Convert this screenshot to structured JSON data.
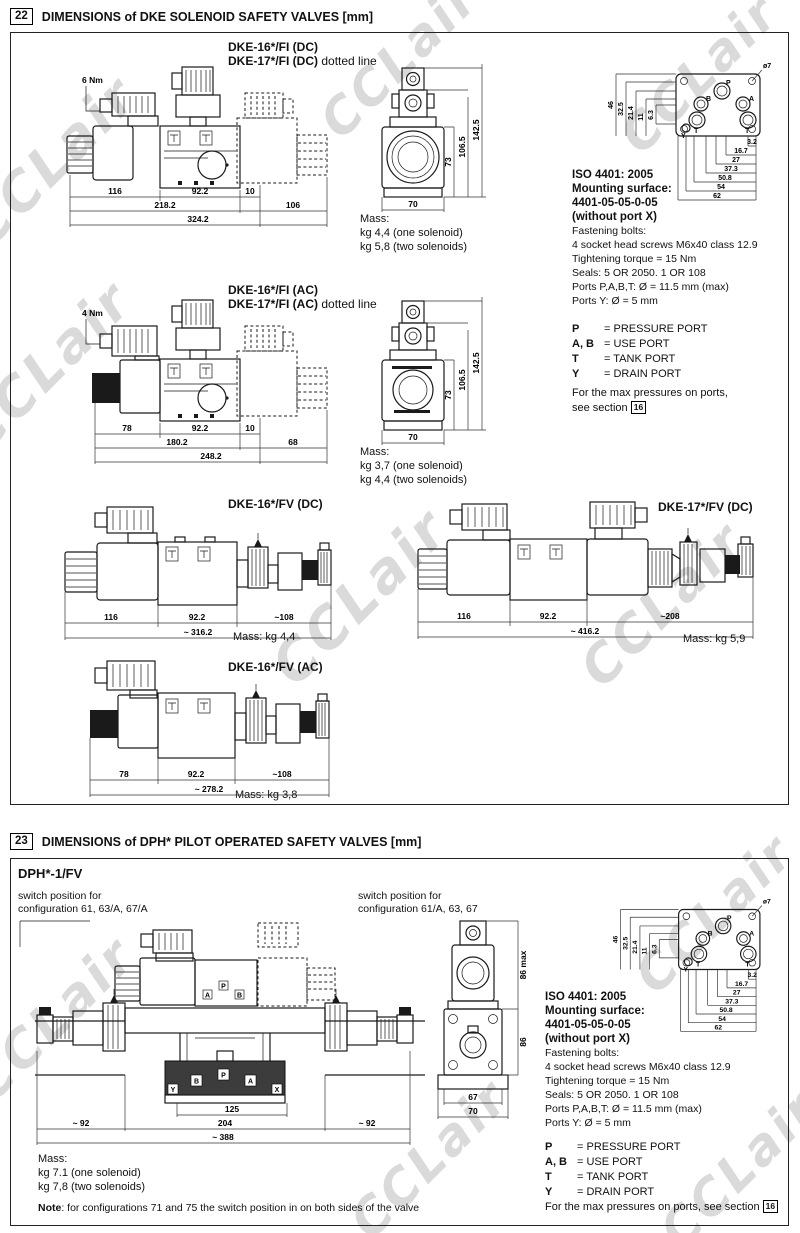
{
  "watermark": "CCLair",
  "sec22": {
    "num": "22",
    "title": "DIMENSIONS of DKE SOLENOID SAFETY VALVES [mm]",
    "fi_dc": {
      "t1": "DKE-16*/FI (DC)",
      "t2": "DKE-17*/FI (DC)",
      "t2s": " dotted line",
      "torque": "6 Nm",
      "d1": "116",
      "d2": "92.2",
      "d3": "10",
      "d4": "218.2",
      "d5": "106",
      "d6": "324.2",
      "mass_l": "Mass:",
      "mass1": "kg 4,4 (one solenoid)",
      "mass2": "kg 5,8 (two solenoids)"
    },
    "fi_ac": {
      "t1": "DKE-16*/FI (AC)",
      "t2": "DKE-17*/FI (AC)",
      "t2s": " dotted line",
      "torque": "4 Nm",
      "d1": "78",
      "d2": "92.2",
      "d3": "10",
      "d4": "180.2",
      "d5": "68",
      "d6": "248.2",
      "mass_l": "Mass:",
      "mass1": "kg 3,7 (one solenoid)",
      "mass2": "kg 4,4 (two solenoids)"
    },
    "fi_front": {
      "w": "70",
      "h1": "73",
      "h2": "106.5",
      "h3": "142.5"
    },
    "fv_dc16": {
      "t": "DKE-16*/FV (DC)",
      "d1": "116",
      "d2": "92.2",
      "d3": "~108",
      "d4": "~ 316.2",
      "mass": "Mass: kg 4,4"
    },
    "fv_dc17": {
      "t": "DKE-17*/FV (DC)",
      "d1": "116",
      "d2": "92.2",
      "d3": "~208",
      "d4": "~ 416.2",
      "mass": "Mass: kg 5,9"
    },
    "fv_ac16": {
      "t": "DKE-16*/FV (AC)",
      "d1": "78",
      "d2": "92.2",
      "d3": "~108",
      "d4": "~ 278.2",
      "mass": "Mass: kg 3,8"
    }
  },
  "iso": {
    "b1": "ISO 4401: 2005",
    "b2": "Mounting surface:",
    "b3": "4401-05-05-0-05",
    "b4": "(without port X)",
    "n1": "Fastening bolts:",
    "n2": "4 socket head screws M6x40 class 12.9",
    "n3": "Tightening torque = 15 Nm",
    "n4": "Seals: 5 OR 2050. 1 OR 108",
    "n5": "Ports P,A,B,T:  Ø = 11.5 mm (max)",
    "n6": "Ports Y: Ø = 5 mm",
    "phi": "ø7",
    "left": [
      "46",
      "32.5",
      "21.4",
      "11",
      "6.3"
    ],
    "bottom": [
      "3.2",
      "16.7",
      "27",
      "37.3",
      "50.8",
      "54",
      "62"
    ],
    "P": "P",
    "A": "A",
    "B": "B",
    "T": "T",
    "Y": "Y"
  },
  "ports": {
    "rows": [
      {
        "k": "P",
        "v": "= PRESSURE PORT"
      },
      {
        "k": "A, B",
        "v": "= USE PORT"
      },
      {
        "k": "T",
        "v": "= TANK PORT"
      },
      {
        "k": "Y",
        "v": "= DRAIN PORT"
      }
    ],
    "max1": "For the max pressures on ports,",
    "max2": "see section",
    "max_inline": "For the max pressures on ports, see section",
    "ref": "16"
  },
  "sec23": {
    "num": "23",
    "title": "DIMENSIONS of DPH* PILOT OPERATED SAFETY VALVES [mm]",
    "model": "DPH*-1/FV",
    "sw_l1": "switch position for",
    "sw_l2": "configuration 61, 63/A, 67/A",
    "sw_r1": "switch position for",
    "sw_r2": "configuration 61/A, 63, 67",
    "d125": "125",
    "d204": "204",
    "d92l": "~ 92",
    "d92r": "~ 92",
    "d388": "~ 388",
    "f86max": "86 max",
    "f86": "86",
    "f67": "67",
    "f70": "70",
    "pA": "A",
    "pP": "P",
    "pB": "B",
    "mB": "B",
    "mP": "P",
    "mA": "A",
    "mY": "Y",
    "mX": "X",
    "mass_l": "Mass:",
    "mass1": "kg 7.1 (one solenoid)",
    "mass2": "kg 7,8 (two solenoids)",
    "note_k": "Note",
    "note_v": ": for configurations 71 and 75 the switch position in on both sides of the valve"
  }
}
